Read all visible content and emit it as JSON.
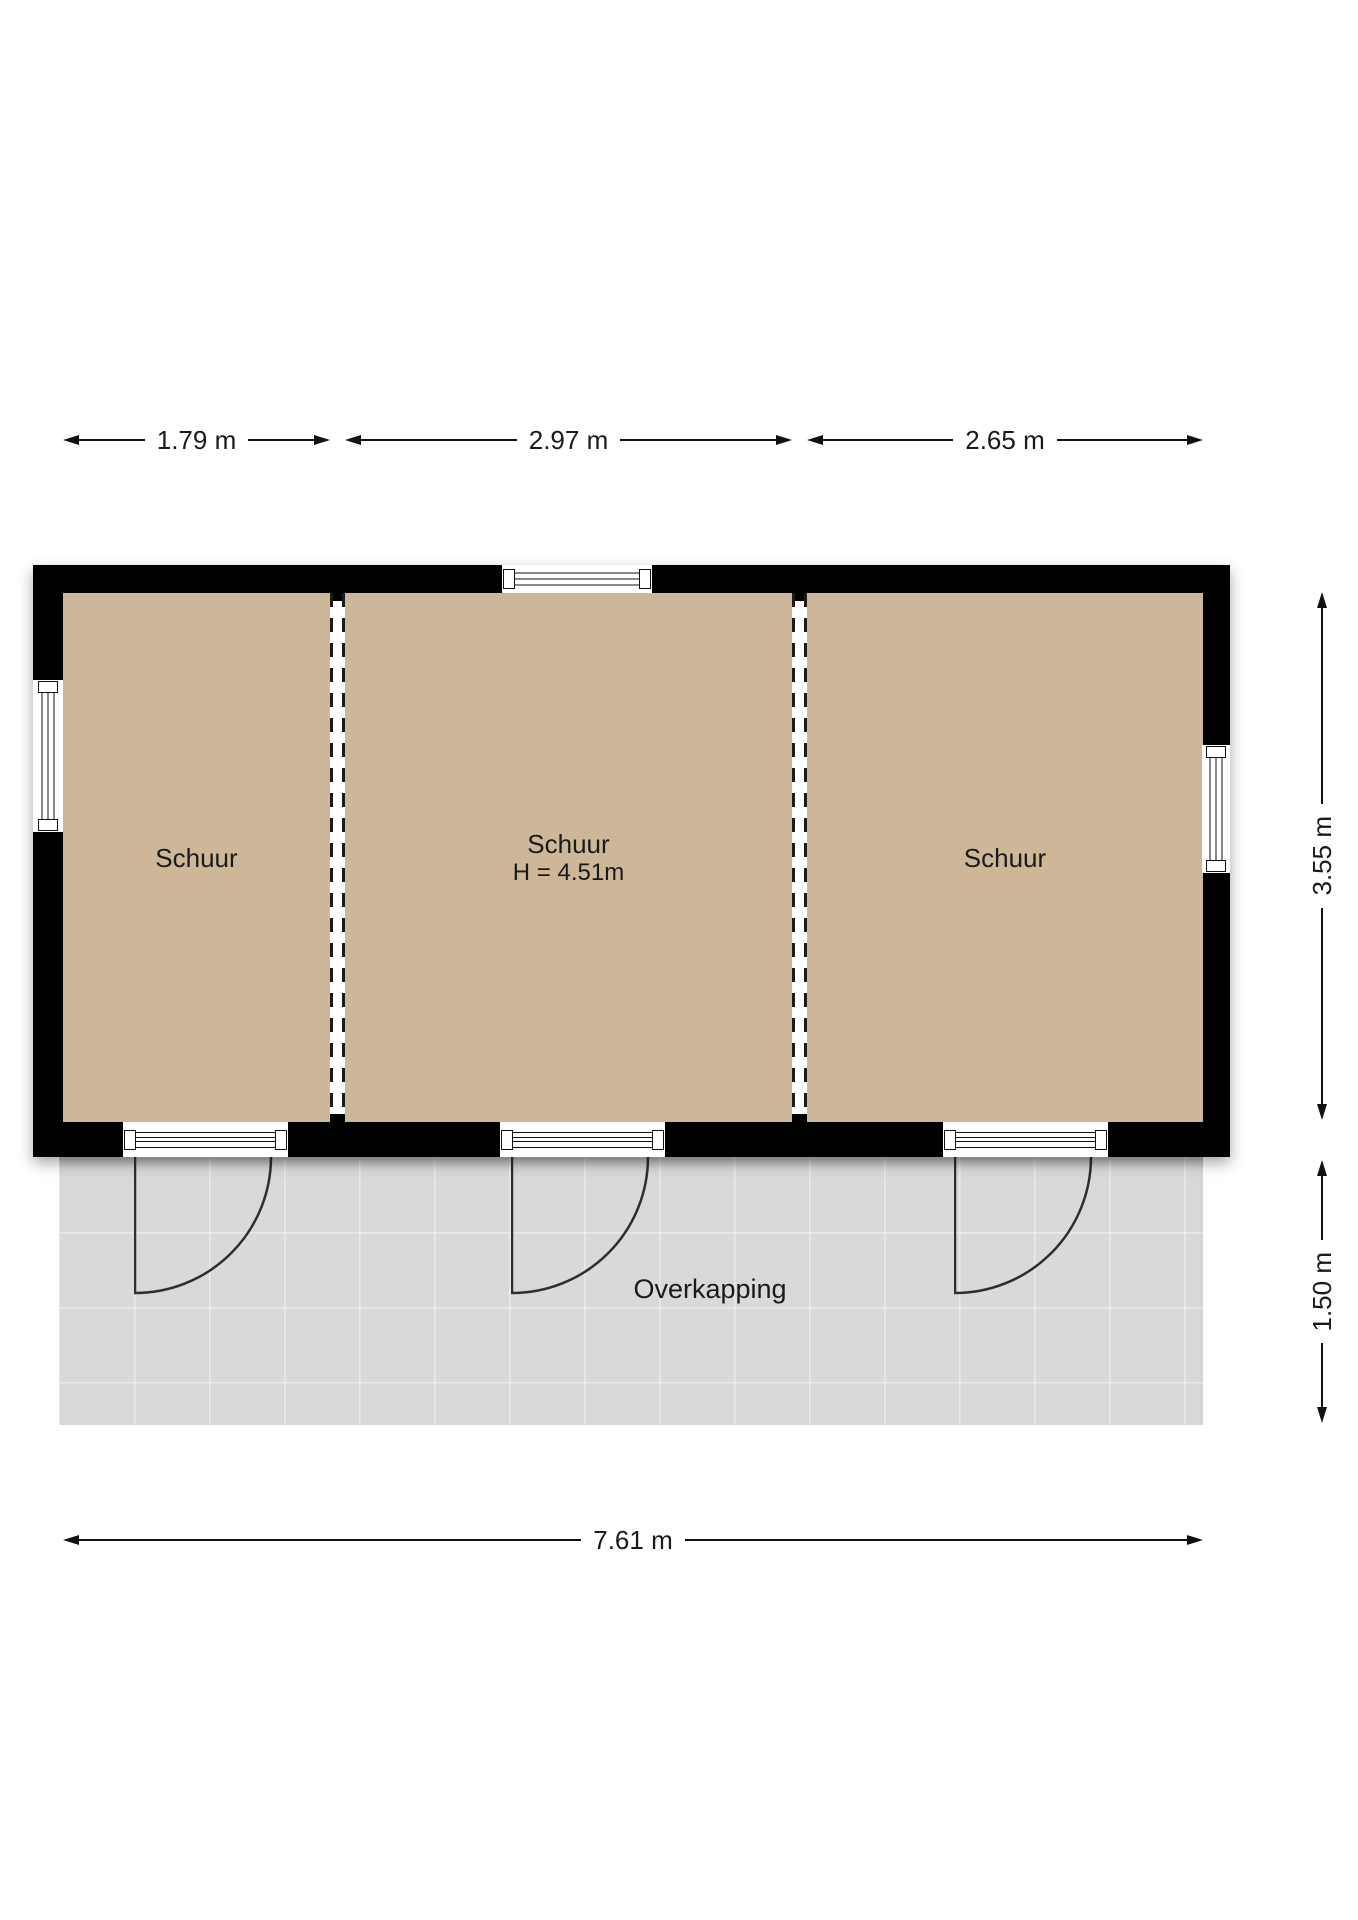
{
  "floor_plan": {
    "rooms": [
      {
        "label": "Schuur"
      },
      {
        "label": "Schuur",
        "height_note": "H = 4.51m"
      },
      {
        "label": "Schuur"
      }
    ],
    "canopy_label": "Overkapping",
    "dimensions": {
      "top": [
        {
          "label": "1.79 m"
        },
        {
          "label": "2.97 m"
        },
        {
          "label": "2.65 m"
        }
      ],
      "right": [
        {
          "label": "3.55 m"
        },
        {
          "label": "1.50 m"
        }
      ],
      "bottom": [
        {
          "label": "7.61 m"
        }
      ]
    },
    "colors": {
      "wall": "#000000",
      "room_fill": "#cdb798",
      "canopy_fill": "#d9d9d9",
      "dimension_line": "#111111",
      "text": "#1a1a1a"
    }
  }
}
